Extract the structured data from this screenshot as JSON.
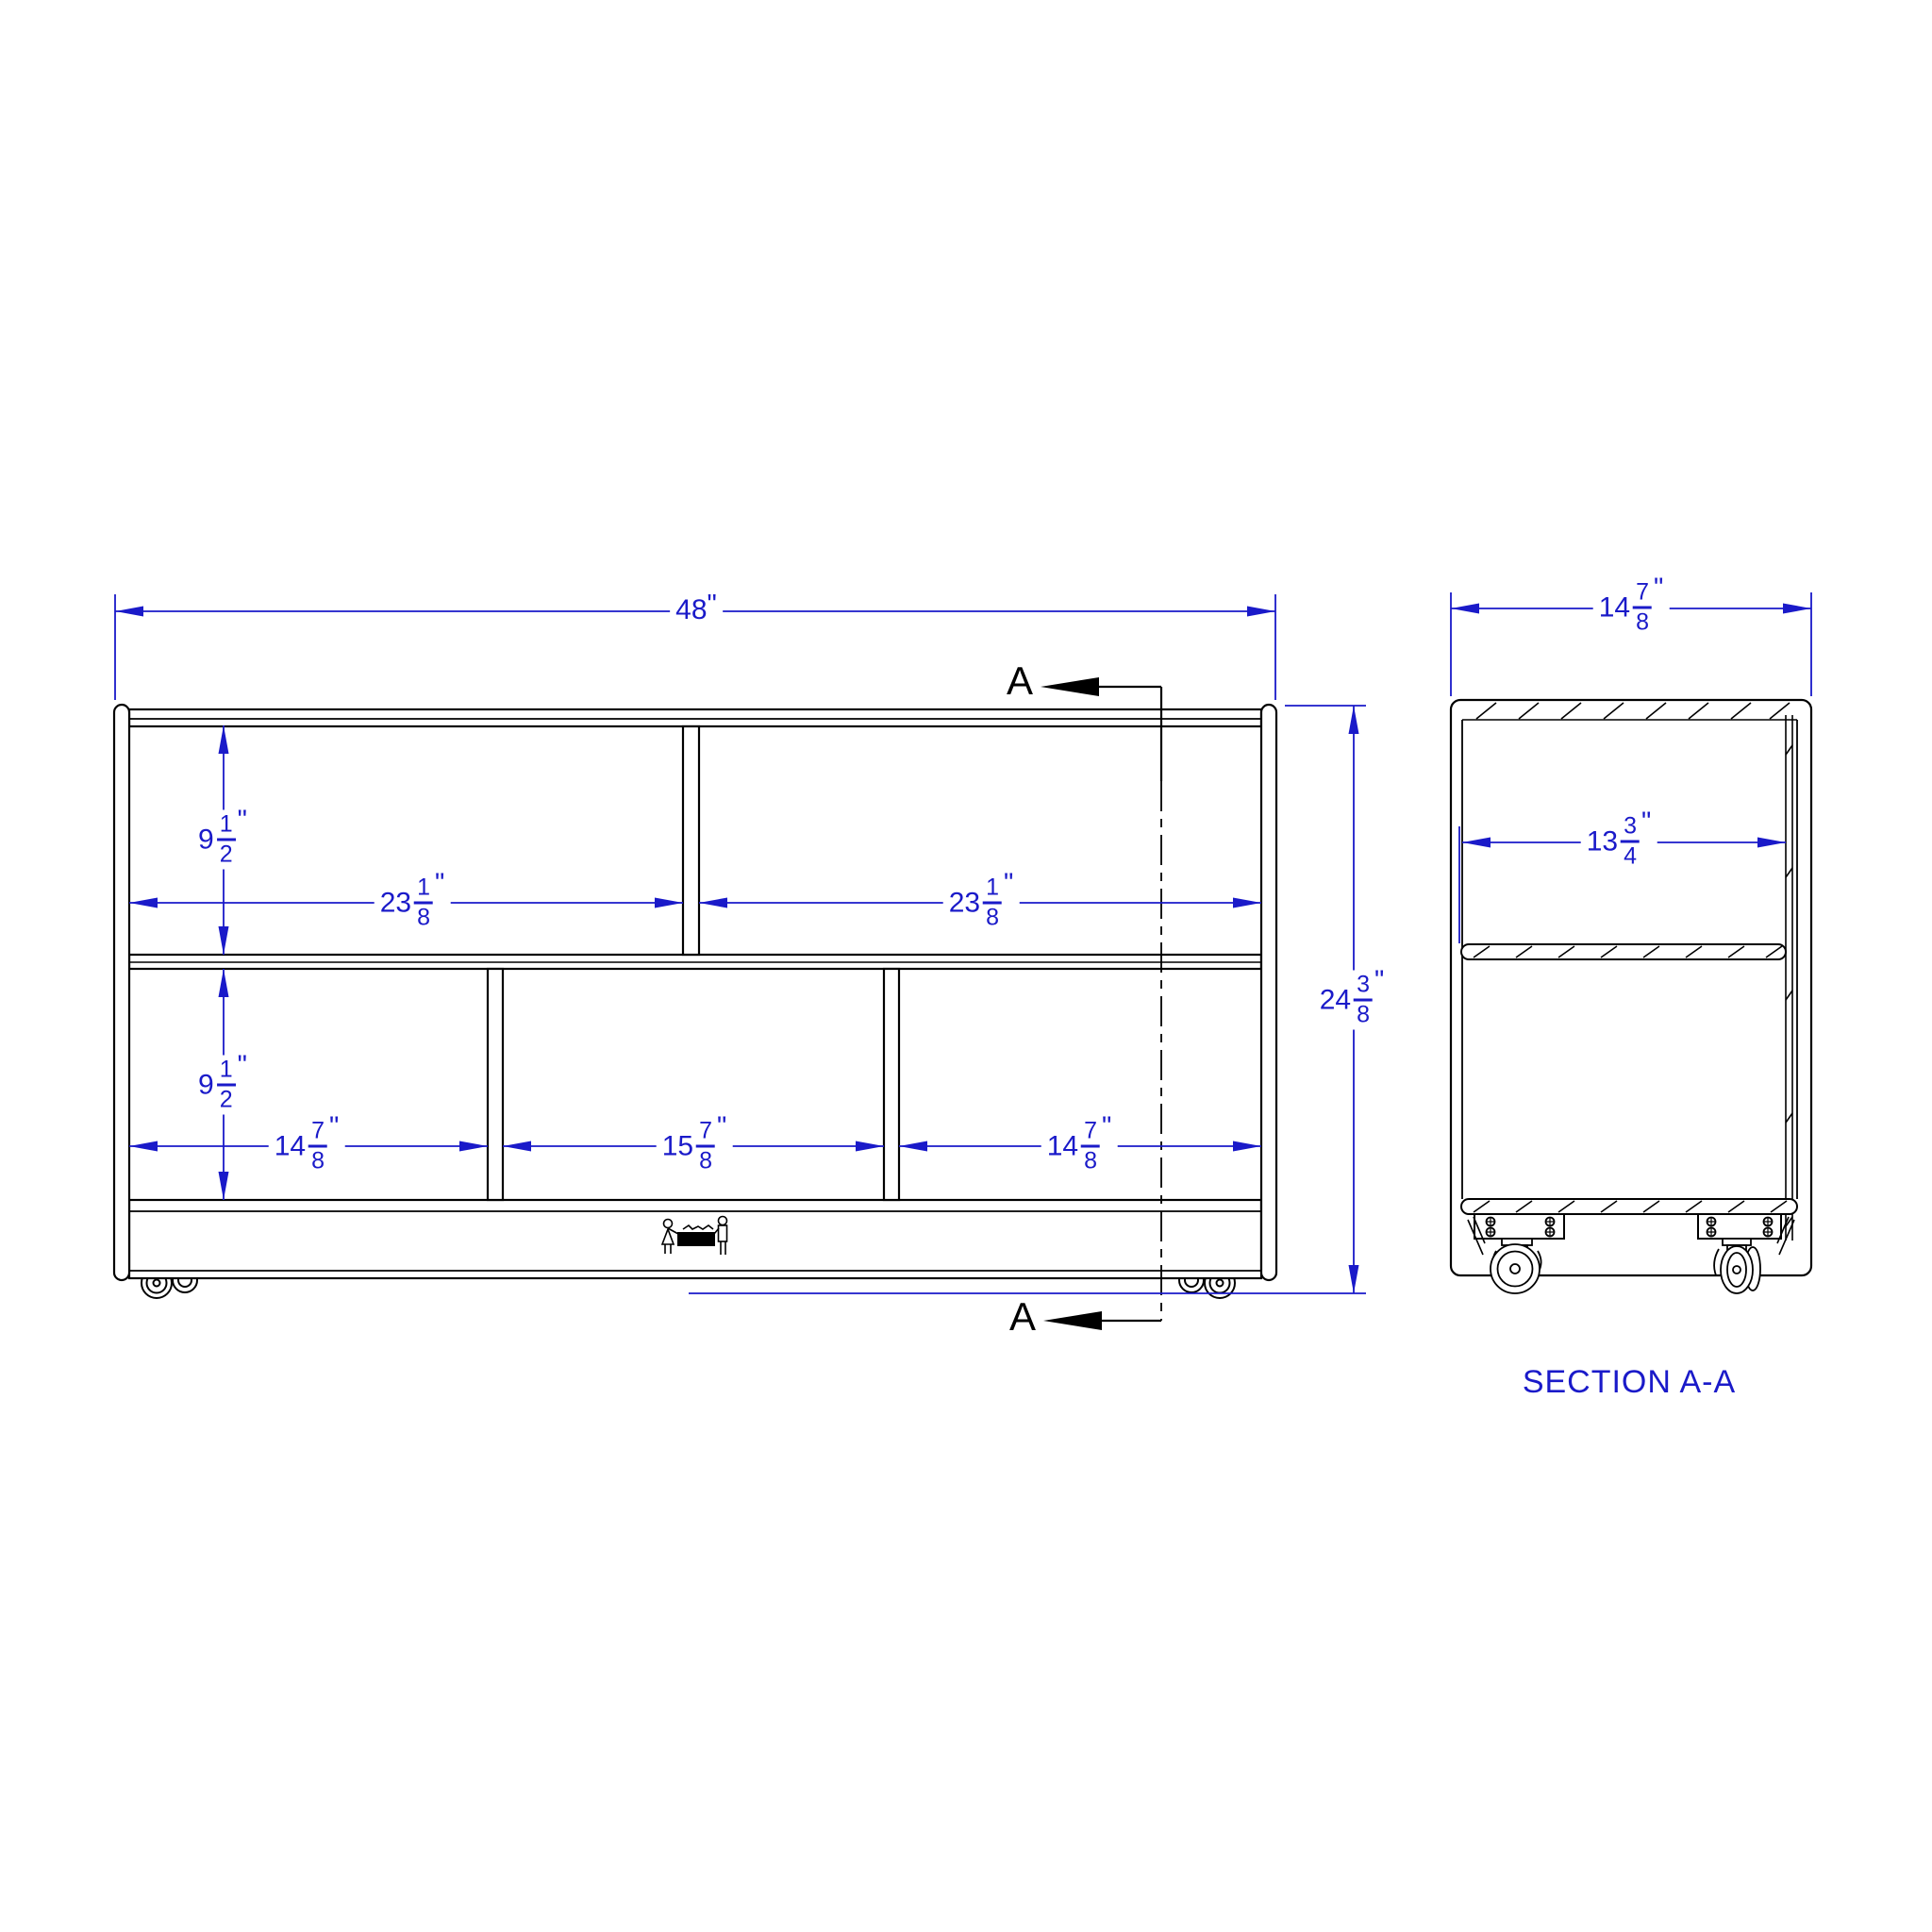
{
  "sheet": {
    "background_color": "#ffffff",
    "line_color": "#000000",
    "dimension_color": "#1a1ac9"
  },
  "front_view": {
    "overall_width": {
      "whole": "48",
      "suffix": "\""
    },
    "overall_height": {
      "whole": "24",
      "numerator": "3",
      "denominator": "8",
      "suffix": "\""
    },
    "top_row_height": {
      "whole": "9",
      "numerator": "1",
      "denominator": "2",
      "suffix": "\""
    },
    "bottom_row_height": {
      "whole": "9",
      "numerator": "1",
      "denominator": "2",
      "suffix": "\""
    },
    "top_left_opening": {
      "whole": "23",
      "numerator": "1",
      "denominator": "8",
      "suffix": "\""
    },
    "top_right_opening": {
      "whole": "23",
      "numerator": "1",
      "denominator": "8",
      "suffix": "\""
    },
    "bottom_left_opening": {
      "whole": "14",
      "numerator": "7",
      "denominator": "8",
      "suffix": "\""
    },
    "bottom_middle_opening": {
      "whole": "15",
      "numerator": "7",
      "denominator": "8",
      "suffix": "\""
    },
    "bottom_right_opening": {
      "whole": "14",
      "numerator": "7",
      "denominator": "8",
      "suffix": "\""
    },
    "section_marker": "A"
  },
  "section_view": {
    "overall_depth": {
      "whole": "14",
      "numerator": "7",
      "denominator": "8",
      "suffix": "\""
    },
    "interior_depth": {
      "whole": "13",
      "numerator": "3",
      "denominator": "4",
      "suffix": "\""
    },
    "title": "SECTION A-A"
  }
}
